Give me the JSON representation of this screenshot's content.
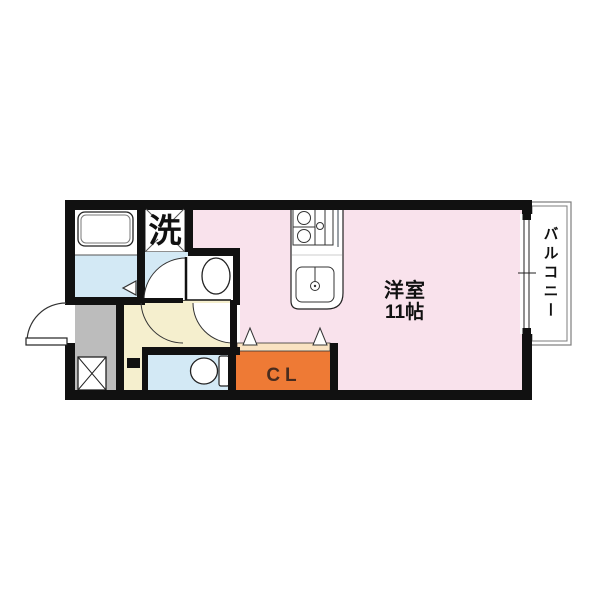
{
  "floorplan": {
    "labels": {
      "washer": "洗",
      "main_room_name": "洋室",
      "main_room_size": "11帖",
      "closet": "CL",
      "balcony": "バルコニー"
    },
    "colors": {
      "wall": "#111111",
      "main_room": "#F9E2EC",
      "wet_area": "#D3E9F5",
      "hallway": "#F5EFCE",
      "entrance": "#BCBCBC",
      "closet": "#EE7A35",
      "closet_door": "#FAE3C2",
      "fixture": "#FFFFFF",
      "balcony_border": "#7D7D7D",
      "closet_text": "#4A2C1E",
      "label_text": "#111111"
    }
  }
}
